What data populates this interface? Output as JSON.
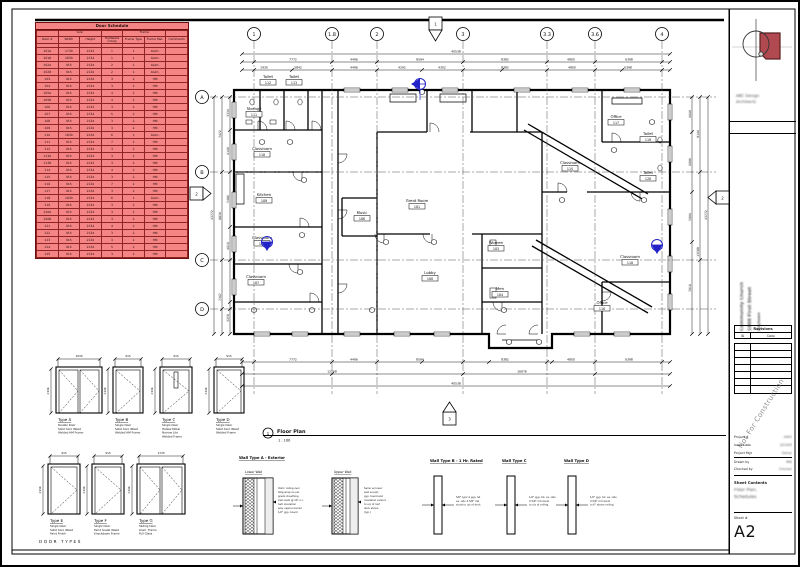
{
  "schedule": {
    "title": "Door Schedule",
    "groups": {
      "size": "Size",
      "frame": "Frame"
    },
    "columns": [
      "Door #",
      "Width",
      "Height",
      "Hardware Group",
      "Frame Type",
      "Frame Mat.",
      "Comments"
    ],
    "rows": [
      [
        "101A",
        "1730",
        "2134",
        "1",
        "1",
        "Alum.",
        ""
      ],
      [
        "101B",
        "1830",
        "2134",
        "1",
        "1",
        "Alum.",
        ""
      ],
      [
        "102A",
        "915",
        "2134",
        "2",
        "1",
        "Alum.",
        ""
      ],
      [
        "102B",
        "915",
        "2134",
        "2",
        "1",
        "Alum.",
        ""
      ],
      [
        "103",
        "915",
        "2134",
        "3",
        "2",
        "HM",
        ""
      ],
      [
        "104",
        "915",
        "2134",
        "3",
        "2",
        "HM",
        ""
      ],
      [
        "105A",
        "915",
        "2134",
        "4",
        "2",
        "HM",
        ""
      ],
      [
        "105B",
        "915",
        "2134",
        "4",
        "2",
        "HM",
        ""
      ],
      [
        "106",
        "915",
        "2134",
        "3",
        "2",
        "HM",
        ""
      ],
      [
        "107",
        "915",
        "2134",
        "5",
        "2",
        "HM",
        ""
      ],
      [
        "108",
        "915",
        "2134",
        "3",
        "2",
        "HM",
        ""
      ],
      [
        "109",
        "915",
        "2134",
        "3",
        "2",
        "HM",
        ""
      ],
      [
        "110",
        "1830",
        "2134",
        "6",
        "1",
        "Alum.",
        ""
      ],
      [
        "111",
        "915",
        "2134",
        "7",
        "2",
        "HM",
        ""
      ],
      [
        "112",
        "915",
        "2134",
        "3",
        "2",
        "HM",
        ""
      ],
      [
        "113A",
        "915",
        "2134",
        "3",
        "2",
        "HM",
        ""
      ],
      [
        "113B",
        "915",
        "2134",
        "3",
        "2",
        "HM",
        ""
      ],
      [
        "114",
        "915",
        "2134",
        "4",
        "2",
        "HM",
        ""
      ],
      [
        "115",
        "915",
        "2134",
        "3",
        "2",
        "HM",
        ""
      ],
      [
        "116",
        "915",
        "2134",
        "7",
        "2",
        "HM",
        ""
      ],
      [
        "117",
        "915",
        "2134",
        "3",
        "2",
        "HM",
        ""
      ],
      [
        "118",
        "1830",
        "2134",
        "6",
        "1",
        "Alum.",
        ""
      ],
      [
        "119",
        "915",
        "2134",
        "3",
        "2",
        "HM",
        ""
      ],
      [
        "120A",
        "915",
        "2134",
        "3",
        "2",
        "HM",
        ""
      ],
      [
        "120B",
        "915",
        "2134",
        "3",
        "2",
        "HM",
        ""
      ],
      [
        "121",
        "915",
        "2134",
        "4",
        "2",
        "HM",
        ""
      ],
      [
        "122",
        "915",
        "2134",
        "3",
        "2",
        "HM",
        ""
      ],
      [
        "123",
        "915",
        "2134",
        "3",
        "2",
        "HM",
        ""
      ],
      [
        "124",
        "915",
        "2134",
        "5",
        "2",
        "HM",
        ""
      ],
      [
        "125",
        "915",
        "2134",
        "3",
        "2",
        "HM",
        ""
      ]
    ]
  },
  "plan": {
    "view_number": "1",
    "view_title": "Floor Plan",
    "view_scale": "1 : 100",
    "grid_top": [
      {
        "label": "1",
        "x": 252
      },
      {
        "label": "1.8",
        "x": 330
      },
      {
        "label": "2",
        "x": 375
      },
      {
        "label": "3",
        "x": 461
      },
      {
        "label": "3.3",
        "x": 545
      },
      {
        "label": "3.6",
        "x": 593
      },
      {
        "label": "4",
        "x": 660
      }
    ],
    "grid_left": [
      {
        "label": "A",
        "y": 95
      },
      {
        "label": "B",
        "y": 170
      },
      {
        "label": "C",
        "y": 258
      },
      {
        "label": "D",
        "y": 307
      }
    ],
    "rooms": [
      {
        "label": "Toilet",
        "number": "112",
        "x": 266,
        "y": 76
      },
      {
        "label": "Toilet",
        "number": "113",
        "x": 292,
        "y": 76
      },
      {
        "label": "Storage",
        "number": "111",
        "x": 252,
        "y": 108
      },
      {
        "label": "Classroom",
        "number": "110",
        "x": 260,
        "y": 148
      },
      {
        "label": "Kitchen",
        "number": "109",
        "x": 262,
        "y": 194
      },
      {
        "label": "Classroom",
        "number": "108",
        "x": 260,
        "y": 237
      },
      {
        "label": "Classroom",
        "number": "107",
        "x": 254,
        "y": 276
      },
      {
        "label": "Great Room",
        "number": "101",
        "x": 415,
        "y": 200
      },
      {
        "label": "Music",
        "number": "106",
        "x": 360,
        "y": 212
      },
      {
        "label": "Lobby",
        "number": "100",
        "x": 428,
        "y": 272
      },
      {
        "label": "Women",
        "number": "103",
        "x": 494,
        "y": 242
      },
      {
        "label": "Men",
        "number": "104",
        "x": 498,
        "y": 288
      },
      {
        "label": "Classroom",
        "number": "115",
        "x": 568,
        "y": 162
      },
      {
        "label": "Office",
        "number": "117",
        "x": 614,
        "y": 116
      },
      {
        "label": "Toilet",
        "number": "119",
        "x": 646,
        "y": 133
      },
      {
        "label": "Toilet",
        "number": "120",
        "x": 646,
        "y": 172
      },
      {
        "label": "Classroom",
        "number": "118",
        "x": 628,
        "y": 256
      },
      {
        "label": "Office",
        "number": "116",
        "x": 600,
        "y": 302
      }
    ],
    "sections": [
      {
        "x": 427,
        "y": 15,
        "dir": "down",
        "label": "1"
      },
      {
        "x": 188,
        "y": 185,
        "dir": "right",
        "label": "2"
      },
      {
        "x": 714,
        "y": 189,
        "dir": "left",
        "label": "2"
      },
      {
        "x": 441,
        "y": 410,
        "dir": "up",
        "label": "3"
      }
    ],
    "elev_markers": [
      {
        "x": 418,
        "y": 82,
        "dir": "left"
      },
      {
        "x": 265,
        "y": 240,
        "dir": "down"
      },
      {
        "x": 655,
        "y": 243,
        "dir": "down"
      }
    ],
    "dim_labels": [
      {
        "x": 454,
        "y": 50.5,
        "t": "40538"
      },
      {
        "x": 291,
        "y": 58.5,
        "t": "7772"
      },
      {
        "x": 352,
        "y": 58.5,
        "t": "4496"
      },
      {
        "x": 418,
        "y": 58.5,
        "t": "8594"
      },
      {
        "x": 503,
        "y": 58.5,
        "t": "8382"
      },
      {
        "x": 569,
        "y": 58.5,
        "t": "4800"
      },
      {
        "x": 627,
        "y": 58.5,
        "t": "6398"
      },
      {
        "x": 262,
        "y": 66.5,
        "t": "1930"
      },
      {
        "x": 296,
        "y": 66.5,
        "t": "5842"
      },
      {
        "x": 352,
        "y": 66.5,
        "t": "4496"
      },
      {
        "x": 400,
        "y": 66.5,
        "t": "4292"
      },
      {
        "x": 440,
        "y": 66.5,
        "t": "4302"
      },
      {
        "x": 503,
        "y": 66.5,
        "t": "8382"
      },
      {
        "x": 570,
        "y": 66.5,
        "t": "4800"
      },
      {
        "x": 626,
        "y": 66.5,
        "t": "6398"
      },
      {
        "x": 211,
        "y": 213,
        "t": "23772",
        "r": 1
      },
      {
        "x": 219,
        "y": 132,
        "t": "7472",
        "r": 1
      },
      {
        "x": 219,
        "y": 214,
        "t": "8839",
        "r": 1
      },
      {
        "x": 219,
        "y": 295,
        "t": "7367",
        "r": 1
      },
      {
        "x": 227,
        "y": 111,
        "t": "3334",
        "r": 1
      },
      {
        "x": 227,
        "y": 149,
        "t": "4140",
        "r": 1
      },
      {
        "x": 227,
        "y": 197,
        "t": "5486",
        "r": 1
      },
      {
        "x": 227,
        "y": 244,
        "t": "4610",
        "r": 1
      },
      {
        "x": 227,
        "y": 316,
        "t": "3259",
        "r": 1
      },
      {
        "x": 689,
        "y": 112,
        "t": "4640",
        "r": 1
      },
      {
        "x": 689,
        "y": 160,
        "t": "6096",
        "r": 1
      },
      {
        "x": 689,
        "y": 215,
        "t": "5004",
        "r": 1
      },
      {
        "x": 689,
        "y": 286,
        "t": "7010",
        "r": 1
      },
      {
        "x": 697,
        "y": 132,
        "t": "9144",
        "r": 1
      },
      {
        "x": 697,
        "y": 250,
        "t": "13589",
        "r": 1
      },
      {
        "x": 705,
        "y": 213,
        "t": "23772",
        "r": 1
      },
      {
        "x": 291,
        "y": 358.5,
        "t": "7772"
      },
      {
        "x": 352,
        "y": 358.5,
        "t": "4496"
      },
      {
        "x": 418,
        "y": 358.5,
        "t": "8594"
      },
      {
        "x": 503,
        "y": 358.5,
        "t": "8382"
      },
      {
        "x": 569,
        "y": 358.5,
        "t": "4800"
      },
      {
        "x": 627,
        "y": 358.5,
        "t": "6398"
      },
      {
        "x": 330,
        "y": 370.5,
        "t": "12268"
      },
      {
        "x": 520,
        "y": 370.5,
        "t": "16976"
      },
      {
        "x": 454,
        "y": 382.5,
        "t": "40538"
      }
    ]
  },
  "door_types": {
    "section_label": "DOOR TYPES",
    "items": [
      {
        "label": "Type A",
        "x": 56,
        "y": 367,
        "w": 42,
        "h": 44,
        "leaves": 2,
        "dim_w": "1830",
        "dim_h": "2134",
        "desc": [
          "Double Door",
          "Solid Core Wood",
          "Welded HM Frame"
        ]
      },
      {
        "label": "Type B",
        "x": 113,
        "y": 367,
        "w": 26,
        "h": 44,
        "leaves": 1,
        "dim_w": "915",
        "dim_h": "2134",
        "desc": [
          "Single Door",
          "Solid Core Wood",
          "Welded HM Frame"
        ]
      },
      {
        "label": "Type C",
        "x": 160,
        "y": 367,
        "w": 28,
        "h": 44,
        "leaves": 1,
        "lite": true,
        "dim_w": "915",
        "dim_h": "2134",
        "desc": [
          "Single Door",
          "Hollow Metal",
          "Narrow Lite",
          "Welded Frame"
        ]
      },
      {
        "label": "Type D",
        "x": 214,
        "y": 367,
        "w": 26,
        "h": 44,
        "leaves": 1,
        "dim_w": "915",
        "dim_h": "2134",
        "desc": [
          "Single Door",
          "Solid Core Wood",
          "Welded Frame"
        ]
      },
      {
        "label": "Type E",
        "x": 48,
        "y": 464,
        "w": 28,
        "h": 48,
        "leaves": 1,
        "dim_w": "915",
        "dim_h": "2134",
        "desc": [
          "Single Door",
          "Solid Core Wood",
          "Paint Finish"
        ]
      },
      {
        "label": "Type F",
        "x": 92,
        "y": 464,
        "w": 28,
        "h": 48,
        "leaves": 1,
        "dim_w": "915",
        "dim_h": "2134",
        "desc": [
          "Single Door",
          "Paint Grade Wood",
          "Knockdown Frame"
        ]
      },
      {
        "label": "Type G",
        "x": 137,
        "y": 464,
        "w": 44,
        "h": 48,
        "leaves": 2,
        "panel": true,
        "dim_w": "1730",
        "dim_h": "2134",
        "desc": [
          "Sliding Door",
          "Alum. Frame",
          "Full Glass"
        ]
      }
    ]
  },
  "wall_types": {
    "type_a": {
      "heading": "Wall Type A - Exterior",
      "hx": 237,
      "sections": [
        {
          "sub": "Lower Wall",
          "x": 241,
          "w": 30
        },
        {
          "sub": "Upper Wall",
          "x": 330,
          "w": 26
        }
      ],
      "ann": [
        [
          "Horiz. siding over",
          "bldg wrap on ext.",
          "grade sheathing",
          "2x6 studs @ 16\" o.c.",
          "batt insulation",
          "poly vapour barrier",
          "1/2\" gyp. board"
        ],
        [
          "Same as lower",
          "wall except:",
          "gyp. board and",
          "insulation extend",
          "to u/s of roof",
          "deck above",
          "(typ.)"
        ]
      ],
      "annx": [
        276,
        362
      ]
    },
    "others": [
      {
        "heading": "Wall Type B - 1 Hr. Rated",
        "hx": 428,
        "rx": 432,
        "ann": [
          "5/8\" type X gyp. bd.",
          "ea. side 3-5/8\" mtl",
          "studs to u/s of deck"
        ]
      },
      {
        "heading": "Wall Type C",
        "hx": 500,
        "rx": 505,
        "ann": [
          "1/2\" gyp. bd. ea. side",
          "3-5/8\" mtl studs",
          "to u/s of ceiling"
        ]
      },
      {
        "heading": "Wall Type D",
        "hx": 562,
        "rx": 566,
        "ann": [
          "1/2\" gyp. bd. ea. side",
          "3-5/8\" mtl studs",
          "to 6\" above ceiling"
        ]
      }
    ]
  },
  "titleblock": {
    "firm_lines": [
      "ABC Design",
      "Architects"
    ],
    "project_lines": [
      "Community Church",
      "1000 First Street",
      "Anytown"
    ],
    "revisions_title": "Revisions",
    "rev_col_id": "ID",
    "rev_col_date": "Date",
    "rev_row_count": 7,
    "watermark": "Not For Construction",
    "fields": [
      {
        "label": "Project #",
        "value": "0443"
      },
      {
        "label": "Issue Date",
        "value": "2/22/05"
      },
      {
        "label": "Project Mgr",
        "value": "Owner"
      },
      {
        "label": "Drawn by",
        "value": "MW"
      },
      {
        "label": "Checked by",
        "value": "Checker"
      }
    ],
    "sheet_contents_label": "Sheet Contents",
    "sheet_contents": [
      "Floor Plan,",
      "Schedules"
    ],
    "sheet_number_label": "Sheet #",
    "sheet_number": "A2"
  }
}
